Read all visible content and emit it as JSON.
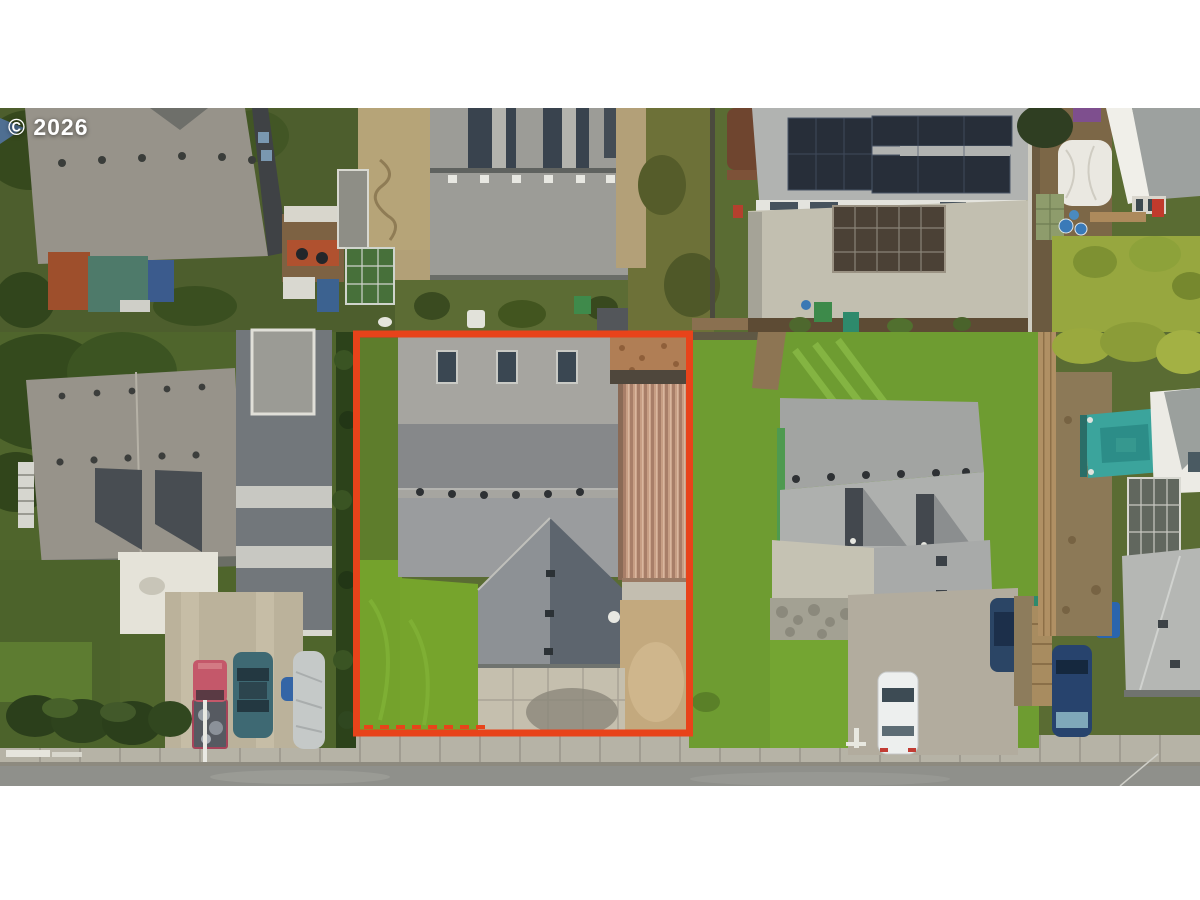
{
  "watermark": {
    "text": "© 2026"
  },
  "scene": {
    "type": "aerial-photo",
    "description": "Top-down drone photo of a residential street; the subject lot is outlined in red and contains a gray-roofed house, a tan metal carport, lawn and a concrete driveway. Neighboring lots show roofs, solar panels, sheds, a teal gazebo, hedges, parked cars and a street with sidewalk."
  },
  "palette": {
    "boundary_red": "#e8431a",
    "lawn_bright": "#76a42c",
    "lawn_mid": "#5e7d2c",
    "lawn_dark": "#4f652c",
    "lawn_neighbor": "#6e9c31",
    "hedge_dark": "#2c421a",
    "street_asphalt": "#8f908b",
    "sidewalk": "#b6b3a6",
    "subject_roof_light": "#a6a5a0",
    "subject_roof_shadow": "#86888a",
    "gable_dark": "#5d656e",
    "gable_light": "#8d9195",
    "carport_tan": "#c79e84",
    "gravel_patch": "#b07e55",
    "driveway_concrete": "#c5bfae",
    "dirt_tan": "#c3a97e",
    "left_roof": "#97938a",
    "center_roof": "#9c9c97",
    "solar_roof": "#b1b3b1",
    "solar_panel": "#272e39",
    "patio_concrete": "#c2bfb0",
    "neighbor_roof": "#a2a4a2",
    "far_roof": "#b5b7b4",
    "gazebo_teal": "#3ba49c",
    "canopy_white": "#eae8e1",
    "fence_wood": "#b09064",
    "white_patio": "#e5e3d9",
    "long_building_roof": "#72777b",
    "car_red": "#c4586a",
    "car_teal": "#3e6973",
    "car_white": "#edefee",
    "car_blue": "#27436d",
    "car_darkblue": "#2b4565",
    "car_cover": "#c5c9c8",
    "bin_green": "#2e8a6c",
    "bin_blue": "#2a65ae",
    "shed_rust": "#9e4f2c",
    "shed_teal": "#4e7a6a"
  }
}
